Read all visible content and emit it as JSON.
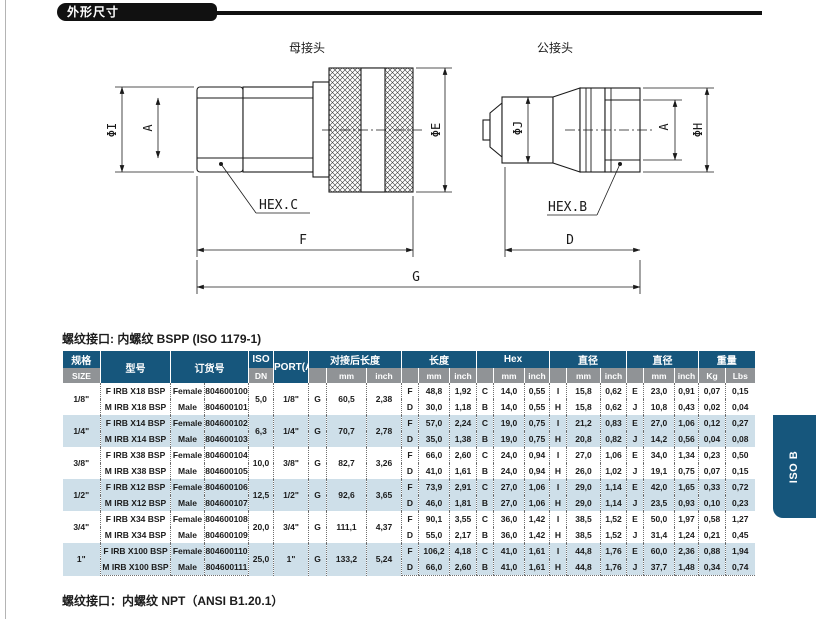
{
  "page": {
    "section_title": "外形尺寸",
    "caption_bspp": "螺纹接口: 内螺纹 BSPP (ISO 1179-1)",
    "caption_npt": "螺纹接口：内螺纹 NPT（ANSI B1.20.1）",
    "side_tab": "ISO B"
  },
  "drawing": {
    "female_title": "母接头",
    "male_title": "公接头",
    "labels": {
      "phi_i": "ΦI",
      "a_female": "A",
      "phi_e": "ΦE",
      "hex_c": "HEX.C",
      "f": "F",
      "g": "G",
      "phi_j": "ΦJ",
      "a_male": "A",
      "phi_h": "ΦH",
      "hex_b": "HEX.B",
      "d": "D"
    }
  },
  "table": {
    "headers": {
      "size_zh": "规格",
      "size_en": "SIZE",
      "model": "型号",
      "order_no": "订货号",
      "iso": "ISO",
      "dn": "DN",
      "port": "PORT(A)",
      "connected_length": "对接后长度",
      "length": "长度",
      "hex": "Hex",
      "diameter1": "直径",
      "diameter2": "直径",
      "weight": "重量",
      "mm": "mm",
      "inch": "inch",
      "kg": "Kg",
      "lbs": "Lbs"
    },
    "rows": [
      {
        "size": "1/8\"",
        "dn": "5,0",
        "port": "1/8\"",
        "g": "G",
        "conn_mm": "60,5",
        "conn_in": "2,38",
        "lines": [
          {
            "model": "F IRB X18 BSP",
            "gender": "Female",
            "order": "804600100",
            "len_l": "F",
            "len_mm": "48,8",
            "len_in": "1,92",
            "hex_l": "C",
            "hex_mm": "14,0",
            "hex_in": "0,55",
            "d1_l": "I",
            "d1_mm": "15,8",
            "d1_in": "0,62",
            "d2_l": "E",
            "d2_mm": "23,0",
            "d2_in": "0,91",
            "kg": "0,07",
            "lbs": "0,15"
          },
          {
            "model": "M IRB X18 BSP",
            "gender": "Male",
            "order": "804600101",
            "len_l": "D",
            "len_mm": "30,0",
            "len_in": "1,18",
            "hex_l": "B",
            "hex_mm": "14,0",
            "hex_in": "0,55",
            "d1_l": "H",
            "d1_mm": "15,8",
            "d1_in": "0,62",
            "d2_l": "J",
            "d2_mm": "10,8",
            "d2_in": "0,43",
            "kg": "0,02",
            "lbs": "0,04"
          }
        ]
      },
      {
        "size": "1/4\"",
        "dn": "6,3",
        "port": "1/4\"",
        "g": "G",
        "conn_mm": "70,7",
        "conn_in": "2,78",
        "lines": [
          {
            "model": "F IRB X14 BSP",
            "gender": "Female",
            "order": "804600102",
            "len_l": "F",
            "len_mm": "57,0",
            "len_in": "2,24",
            "hex_l": "C",
            "hex_mm": "19,0",
            "hex_in": "0,75",
            "d1_l": "I",
            "d1_mm": "21,2",
            "d1_in": "0,83",
            "d2_l": "E",
            "d2_mm": "27,0",
            "d2_in": "1,06",
            "kg": "0,12",
            "lbs": "0,27"
          },
          {
            "model": "M IRB X14 BSP",
            "gender": "Male",
            "order": "804600103",
            "len_l": "D",
            "len_mm": "35,0",
            "len_in": "1,38",
            "hex_l": "B",
            "hex_mm": "19,0",
            "hex_in": "0,75",
            "d1_l": "H",
            "d1_mm": "20,8",
            "d1_in": "0,82",
            "d2_l": "J",
            "d2_mm": "14,2",
            "d2_in": "0,56",
            "kg": "0,04",
            "lbs": "0,08"
          }
        ]
      },
      {
        "size": "3/8\"",
        "dn": "10,0",
        "port": "3/8\"",
        "g": "G",
        "conn_mm": "82,7",
        "conn_in": "3,26",
        "lines": [
          {
            "model": "F IRB X38 BSP",
            "gender": "Female",
            "order": "804600104",
            "len_l": "F",
            "len_mm": "66,0",
            "len_in": "2,60",
            "hex_l": "C",
            "hex_mm": "24,0",
            "hex_in": "0,94",
            "d1_l": "I",
            "d1_mm": "27,0",
            "d1_in": "1,06",
            "d2_l": "E",
            "d2_mm": "34,0",
            "d2_in": "1,34",
            "kg": "0,23",
            "lbs": "0,50"
          },
          {
            "model": "M IRB X38 BSP",
            "gender": "Male",
            "order": "804600105",
            "len_l": "D",
            "len_mm": "41,0",
            "len_in": "1,61",
            "hex_l": "B",
            "hex_mm": "24,0",
            "hex_in": "0,94",
            "d1_l": "H",
            "d1_mm": "26,0",
            "d1_in": "1,02",
            "d2_l": "J",
            "d2_mm": "19,1",
            "d2_in": "0,75",
            "kg": "0,07",
            "lbs": "0,15"
          }
        ]
      },
      {
        "size": "1/2\"",
        "dn": "12,5",
        "port": "1/2\"",
        "g": "G",
        "conn_mm": "92,6",
        "conn_in": "3,65",
        "lines": [
          {
            "model": "F IRB X12 BSP",
            "gender": "Female",
            "order": "804600106",
            "len_l": "F",
            "len_mm": "73,9",
            "len_in": "2,91",
            "hex_l": "C",
            "hex_mm": "27,0",
            "hex_in": "1,06",
            "d1_l": "I",
            "d1_mm": "29,0",
            "d1_in": "1,14",
            "d2_l": "E",
            "d2_mm": "42,0",
            "d2_in": "1,65",
            "kg": "0,33",
            "lbs": "0,72"
          },
          {
            "model": "M IRB X12 BSP",
            "gender": "Male",
            "order": "804600107",
            "len_l": "D",
            "len_mm": "46,0",
            "len_in": "1,81",
            "hex_l": "B",
            "hex_mm": "27,0",
            "hex_in": "1,06",
            "d1_l": "H",
            "d1_mm": "29,0",
            "d1_in": "1,14",
            "d2_l": "J",
            "d2_mm": "23,5",
            "d2_in": "0,93",
            "kg": "0,10",
            "lbs": "0,23"
          }
        ]
      },
      {
        "size": "3/4\"",
        "dn": "20,0",
        "port": "3/4\"",
        "g": "G",
        "conn_mm": "111,1",
        "conn_in": "4,37",
        "lines": [
          {
            "model": "F IRB X34 BSP",
            "gender": "Female",
            "order": "804600108",
            "len_l": "F",
            "len_mm": "90,1",
            "len_in": "3,55",
            "hex_l": "C",
            "hex_mm": "36,0",
            "hex_in": "1,42",
            "d1_l": "I",
            "d1_mm": "38,5",
            "d1_in": "1,52",
            "d2_l": "E",
            "d2_mm": "50,0",
            "d2_in": "1,97",
            "kg": "0,58",
            "lbs": "1,27"
          },
          {
            "model": "M IRB X34 BSP",
            "gender": "Male",
            "order": "804600109",
            "len_l": "D",
            "len_mm": "55,0",
            "len_in": "2,17",
            "hex_l": "B",
            "hex_mm": "36,0",
            "hex_in": "1,42",
            "d1_l": "H",
            "d1_mm": "38,5",
            "d1_in": "1,52",
            "d2_l": "J",
            "d2_mm": "31,4",
            "d2_in": "1,24",
            "kg": "0,21",
            "lbs": "0,45"
          }
        ]
      },
      {
        "size": "1\"",
        "dn": "25,0",
        "port": "1\"",
        "g": "G",
        "conn_mm": "133,2",
        "conn_in": "5,24",
        "lines": [
          {
            "model": "F IRB X100 BSP",
            "gender": "Female",
            "order": "804600110",
            "len_l": "F",
            "len_mm": "106,2",
            "len_in": "4,18",
            "hex_l": "C",
            "hex_mm": "41,0",
            "hex_in": "1,61",
            "d1_l": "I",
            "d1_mm": "44,8",
            "d1_in": "1,76",
            "d2_l": "E",
            "d2_mm": "60,0",
            "d2_in": "2,36",
            "kg": "0,88",
            "lbs": "1,94"
          },
          {
            "model": "M IRB X100 BSP",
            "gender": "Male",
            "order": "804600111",
            "len_l": "D",
            "len_mm": "66,0",
            "len_in": "2,60",
            "hex_l": "B",
            "hex_mm": "41,0",
            "hex_in": "1,61",
            "d1_l": "H",
            "d1_mm": "44,8",
            "d1_in": "1,76",
            "d2_l": "J",
            "d2_mm": "37,7",
            "d2_in": "1,48",
            "kg": "0,34",
            "lbs": "0,74"
          }
        ]
      }
    ]
  },
  "colors": {
    "header_blue": "#16567C",
    "subheader_gray": "#909396",
    "row_alt_blue": "#CEDFE9",
    "bar_black": "#111111"
  }
}
